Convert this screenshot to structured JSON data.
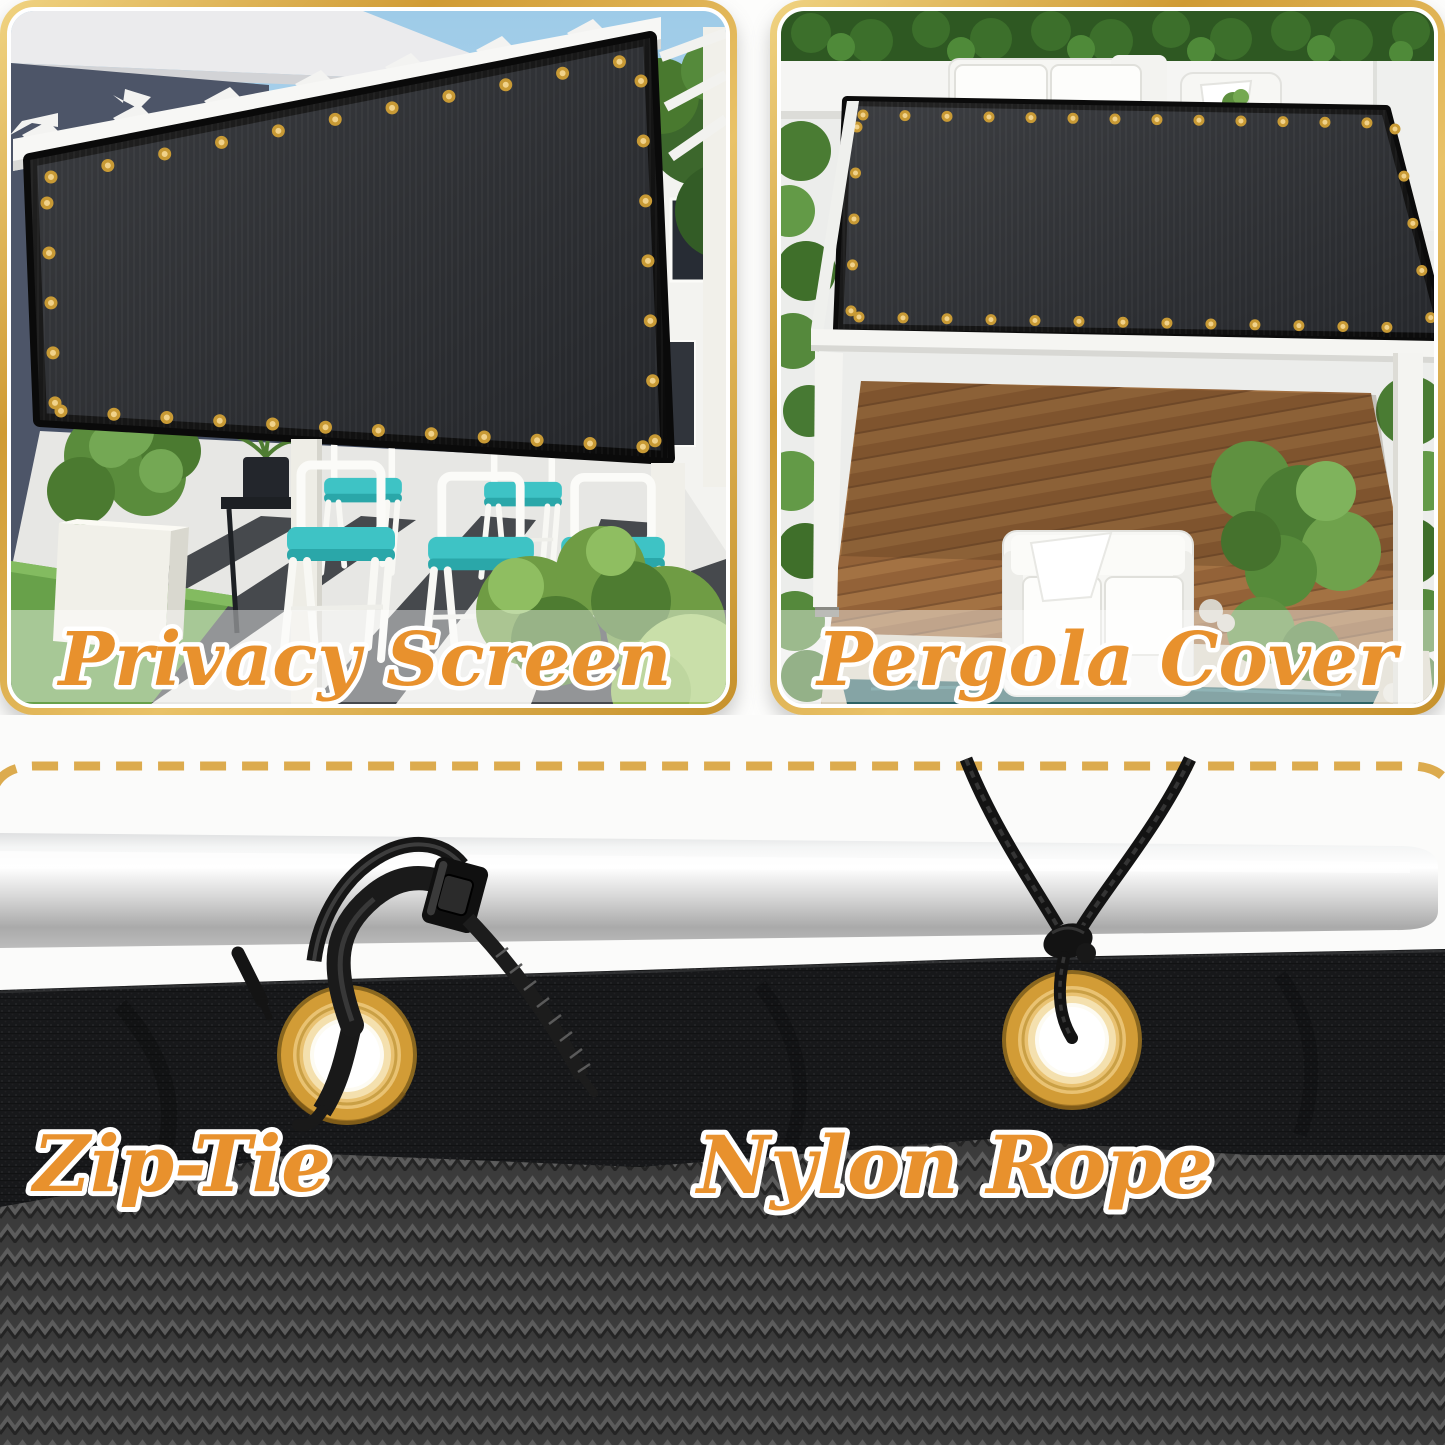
{
  "image_type": "product-feature-collage",
  "product": "black shade mesh / privacy screen with grommets",
  "panels": {
    "privacy_screen": {
      "label": "Privacy Screen"
    },
    "pergola_cover": {
      "label": "Pergola Cover"
    }
  },
  "installation_details": {
    "zip_tie": {
      "label": "Zip-Tie"
    },
    "nylon_rope": {
      "label": "Nylon Rope"
    }
  },
  "colors": {
    "label_orange": "#E8912D",
    "label_outline": "#FFFFFF",
    "frame_gold": "#D9A83F",
    "dashed_line_gold": "#DCAB4E",
    "grommet_gold": "#D9A23C",
    "mesh_dark": "#17181A",
    "mesh_knit_gray": "#3B3B3B",
    "pole_silver": "#D7D7D7",
    "cushion_teal": "#3EC3C5"
  }
}
